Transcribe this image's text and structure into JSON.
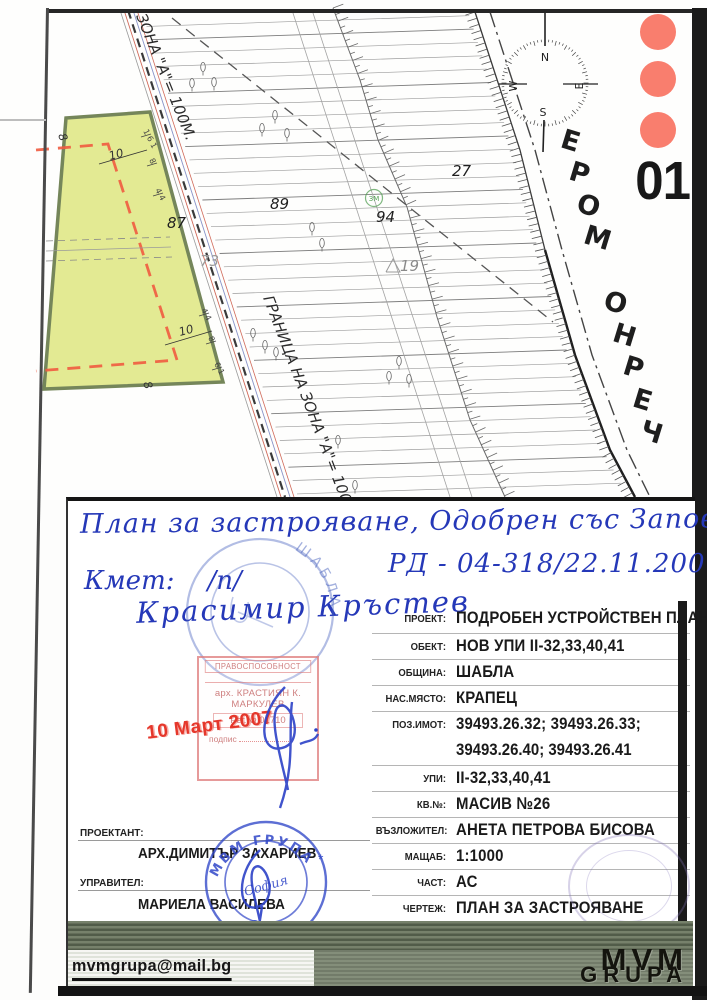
{
  "page": {
    "sheet_number": "01",
    "sea_label": "ЧЕРНО МОРЕ"
  },
  "map": {
    "zone_label": "ЗОНА \"А\"= 100М.",
    "boundary_label": "ГРАНИЦА НА ЗОНА \"А\"= 100М.",
    "green_marker": "ЗМ",
    "compass": {
      "n": "N",
      "e": "E",
      "s": "S",
      "w": "W"
    },
    "labels": [
      {
        "t": "89",
        "x": 270,
        "y": 209,
        "c": "#1f1f1f"
      },
      {
        "t": "94",
        "x": 376,
        "y": 222,
        "c": "#1f1f1f"
      },
      {
        "t": "27",
        "x": 452,
        "y": 176,
        "c": "#1f1f1f"
      },
      {
        "t": "87",
        "x": 167,
        "y": 228,
        "c": "#1f1f1f"
      },
      {
        "t": "73",
        "x": 200,
        "y": 266,
        "c": "#9a9a9a"
      },
      {
        "t": "19",
        "x": 400,
        "y": 271,
        "c": "#8a8a8a"
      }
    ],
    "dims": [
      {
        "t": "10",
        "x": 110,
        "y": 160,
        "r": -15
      },
      {
        "t": "10",
        "x": 180,
        "y": 336,
        "r": -15
      },
      {
        "t": "8",
        "x": 58,
        "y": 135,
        "r": 70
      },
      {
        "t": "8",
        "x": 143,
        "y": 383,
        "r": 70
      }
    ],
    "tick_dims": [
      {
        "t": "1 6 1",
        "x": 143,
        "y": 131
      },
      {
        "t": "8",
        "x": 149,
        "y": 160
      },
      {
        "t": "4 4",
        "x": 155,
        "y": 190
      },
      {
        "t": "4 4",
        "x": 201,
        "y": 310
      },
      {
        "t": "8",
        "x": 208,
        "y": 338
      },
      {
        "t": "6 1",
        "x": 214,
        "y": 364
      }
    ],
    "trees": [
      [
        203,
        67
      ],
      [
        192,
        83
      ],
      [
        214,
        82
      ],
      [
        275,
        115
      ],
      [
        262,
        128
      ],
      [
        287,
        133
      ],
      [
        312,
        227
      ],
      [
        322,
        243
      ],
      [
        253,
        333
      ],
      [
        265,
        345
      ],
      [
        276,
        352
      ],
      [
        399,
        361
      ],
      [
        389,
        376
      ],
      [
        409,
        379
      ],
      [
        355,
        485
      ],
      [
        338,
        440
      ]
    ],
    "contours": {
      "count": 36,
      "y0": 18,
      "dy": 13.5,
      "slope": -0.033
    }
  },
  "handwriting": {
    "line1": "План за застрояване, Одобрен със Заповед",
    "line2": "РД - 04-318/22.11.2007",
    "line3": "Кмет:    /п/",
    "line4": "Красимир Кръстев"
  },
  "stamps": {
    "municipal_round": {
      "ring_text": "ШАБЛА"
    },
    "certificate": {
      "title": "ПРАВОСПОСОБНОСТ",
      "name_line1": "арх. КРАСТИЯН К.",
      "name_line2": "МАРКУЛЕВ",
      "reg": "Рег.№ 01710",
      "sign_label": "подпис",
      "date": "10 Март 2007"
    },
    "company_round": {
      "top": "МВМ ГРУПА",
      "middle": "София",
      "bottom": "ООД",
      "star": "*"
    }
  },
  "title_block": {
    "rows": [
      {
        "label": "ПРОЕКТ:",
        "value": "ПОДРОБЕН УСТРОЙСТВЕН ПЛАН"
      },
      {
        "label": "ОБЕКТ:",
        "value": "НОВ УПИ II-32,33,40,41"
      },
      {
        "label": "ОБЩИНА:",
        "value": "ШАБЛА"
      },
      {
        "label": "НАС.МЯСТО:",
        "value": "КРАПЕЦ"
      },
      {
        "label": "ПОЗ.ИМОТ:",
        "value": "39493.26.32; 39493.26.33;",
        "value2": "39493.26.40; 39493.26.41"
      },
      {
        "label": "УПИ:",
        "value": "II-32,33,40,41"
      },
      {
        "label": "КВ.№:",
        "value": "МАСИВ №26"
      },
      {
        "label": "ВЪЗЛОЖИТЕЛ:",
        "value": "АНЕТА ПЕТРОВА БИСОВА"
      },
      {
        "label": "МАЩАБ:",
        "value": "1:1000"
      },
      {
        "label": "ЧАСТ:",
        "value": "АС"
      },
      {
        "label": "ЧЕРТЕЖ:",
        "value": "ПЛАН ЗА ЗАСТРОЯВАНЕ"
      }
    ],
    "left": {
      "designer_label": "ПРОЕКТАНТ:",
      "designer_name": "АРХ.ДИМИТЪР ЗАХАРИЕВ",
      "manager_label": "УПРАВИТЕЛ:",
      "manager_name": "МАРИЕЛА ВАСИЛЕВА"
    }
  },
  "footer": {
    "email": "mvmgrupa@mail.bg",
    "logo_top": "MVM",
    "logo_bottom": "GRUPA"
  },
  "colors": {
    "accent_red": "#f97e6e",
    "parcel_fill": "#e3ea93",
    "ink_blue": "#2538b8",
    "stamp_red": "#e5372b"
  }
}
